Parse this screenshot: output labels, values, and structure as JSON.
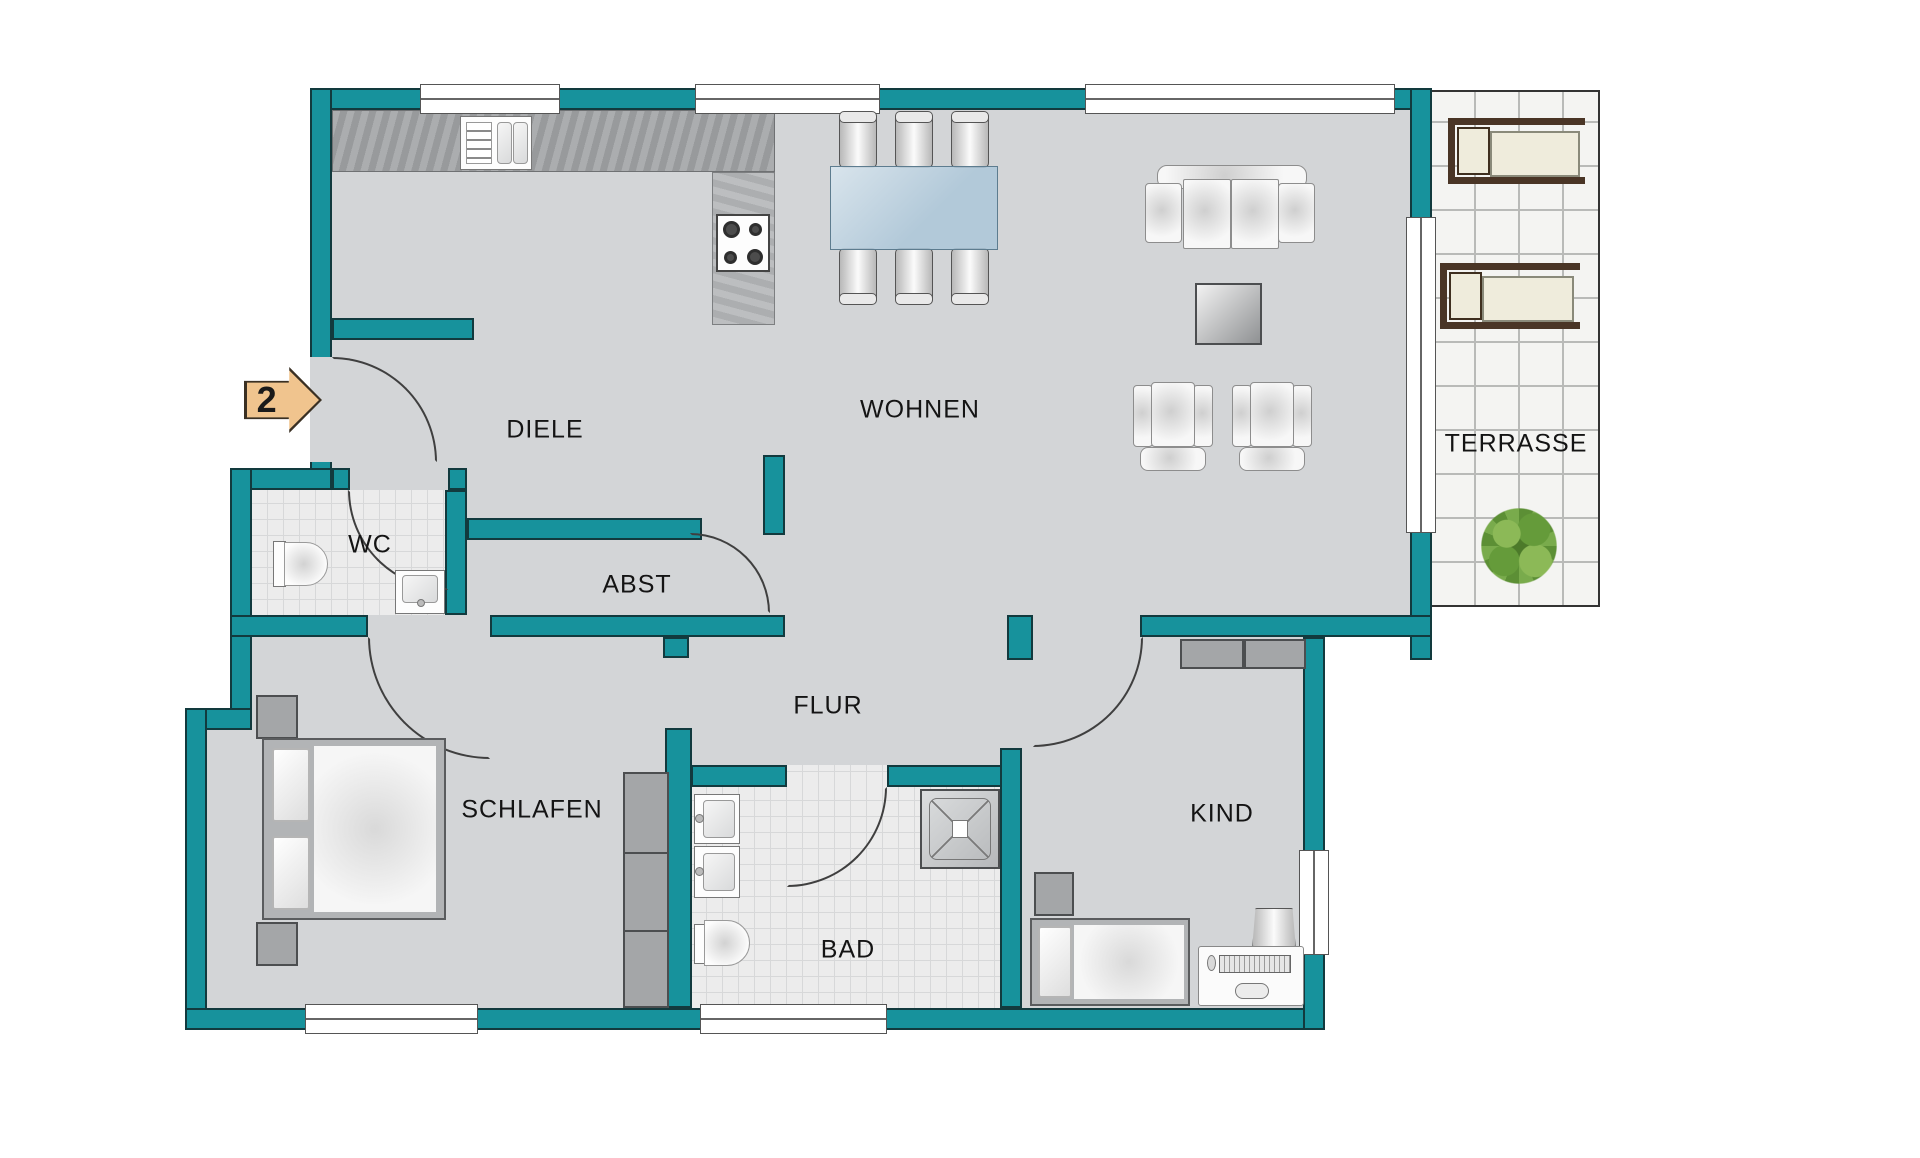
{
  "marker": {
    "label": "2"
  },
  "rooms": [
    {
      "id": "diele",
      "label": "DIELE"
    },
    {
      "id": "wohnen",
      "label": "WOHNEN"
    },
    {
      "id": "wc",
      "label": "WC"
    },
    {
      "id": "abst",
      "label": "ABST"
    },
    {
      "id": "flur",
      "label": "FLUR"
    },
    {
      "id": "schlafen",
      "label": "SCHLAFEN"
    },
    {
      "id": "bad",
      "label": "BAD"
    },
    {
      "id": "kind",
      "label": "KIND"
    },
    {
      "id": "terrasse",
      "label": "TERRASSE"
    }
  ],
  "colors": {
    "wall": "#17929c",
    "floor": "#d3d5d7",
    "terrace": "#f4f4f2",
    "counter": "#a2a4a6",
    "table_blue": "#abc7d9",
    "marker": "#f0c48e"
  }
}
